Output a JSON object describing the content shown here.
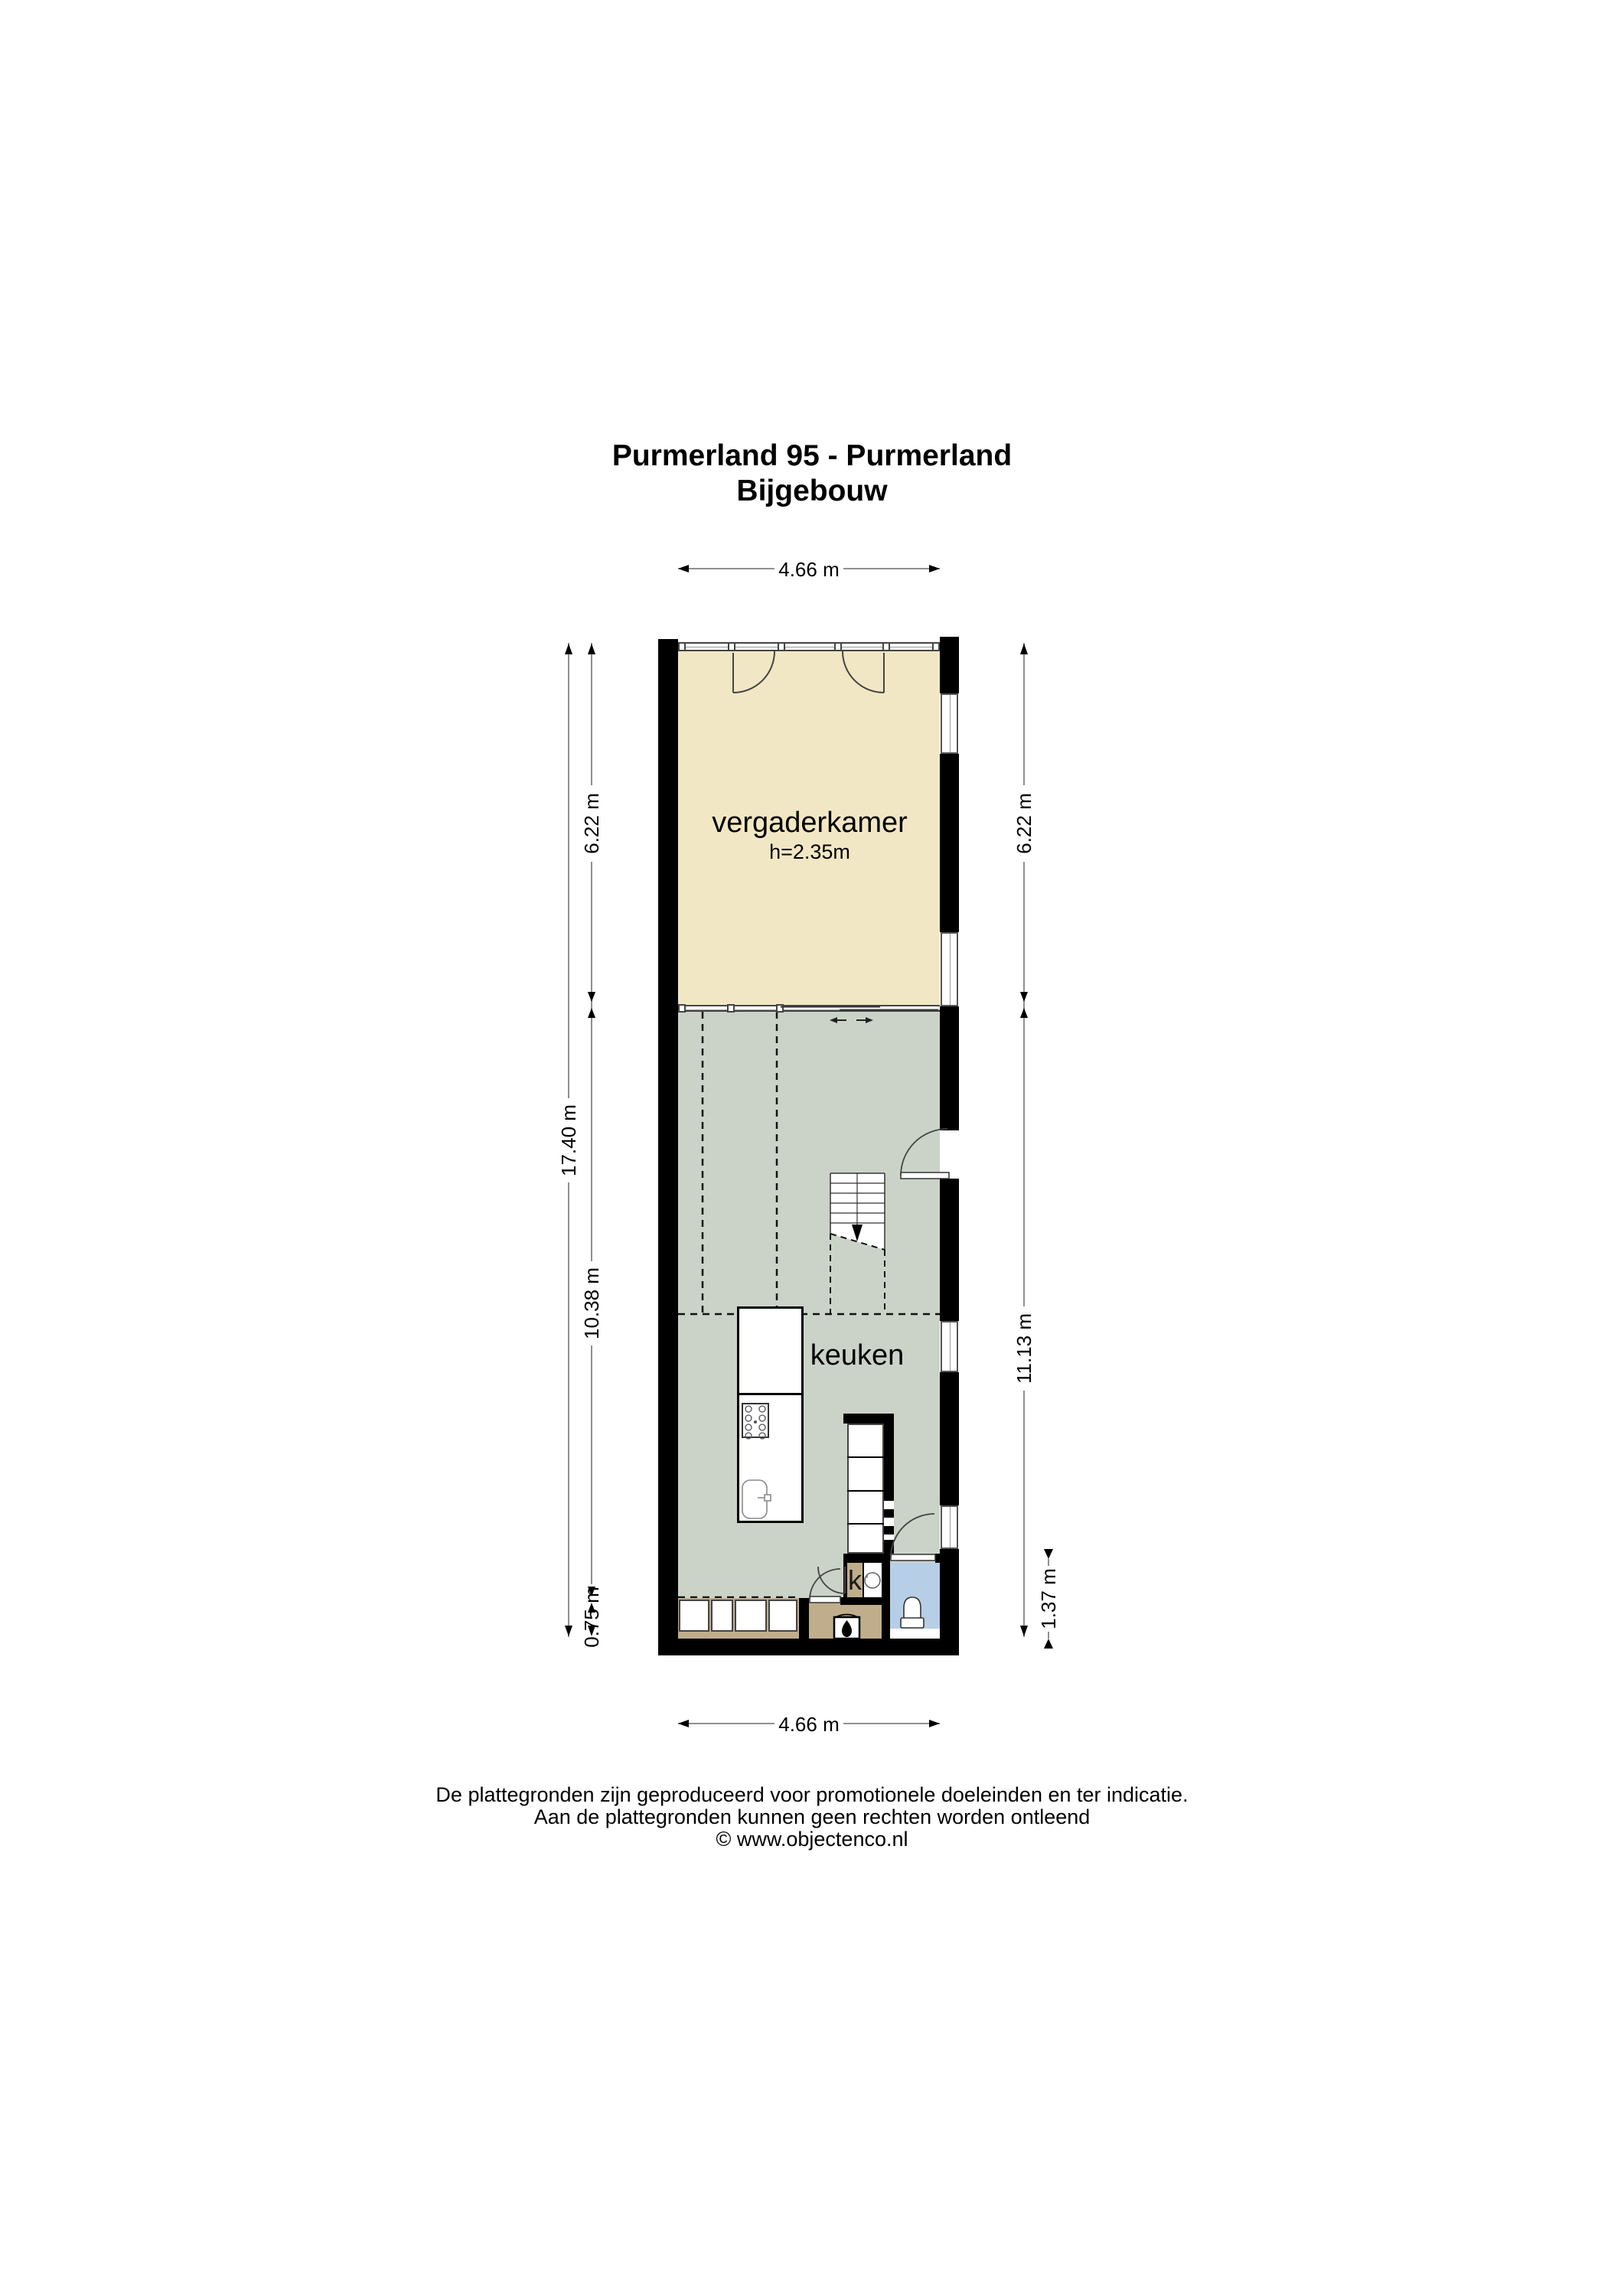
{
  "title": {
    "line1": "Purmerland 95 - Purmerland",
    "line2": "Bijgebouw"
  },
  "rooms": {
    "vergaderkamer": {
      "label": "vergaderkamer",
      "height": "h=2.35m"
    },
    "keuken": {
      "label": "keuken"
    },
    "kast": {
      "label": "k"
    }
  },
  "dims": {
    "top": "4.66 m",
    "bottom": "4.66 m",
    "left_total": "17.40 m",
    "left": [
      "6.22 m",
      "10.38 m",
      "0.75 m"
    ],
    "right": [
      "6.22 m",
      "11.13 m"
    ],
    "bath": "1.37 m"
  },
  "footer": {
    "l1": "De plattegronden zijn geproduceerd voor promotionele doeleinden en ter indicatie.",
    "l2": "Aan de plattegronden kunnen geen rechten worden ontleend",
    "l3": "© www.objectenco.nl"
  },
  "icons": {
    "stove": "flame-icon",
    "toilet": "toilet-icon",
    "sink": "sink-icon",
    "hob": "hob-icon",
    "boiler": "boiler-icon",
    "stairs": "stairs-down-icon"
  },
  "colors": {
    "beige": "#f2e7c4",
    "sage": "#cbd3c8",
    "tan": "#c0ad8c",
    "blue": "#b7cfe6",
    "wall": "#000000",
    "dim": "#909090"
  }
}
